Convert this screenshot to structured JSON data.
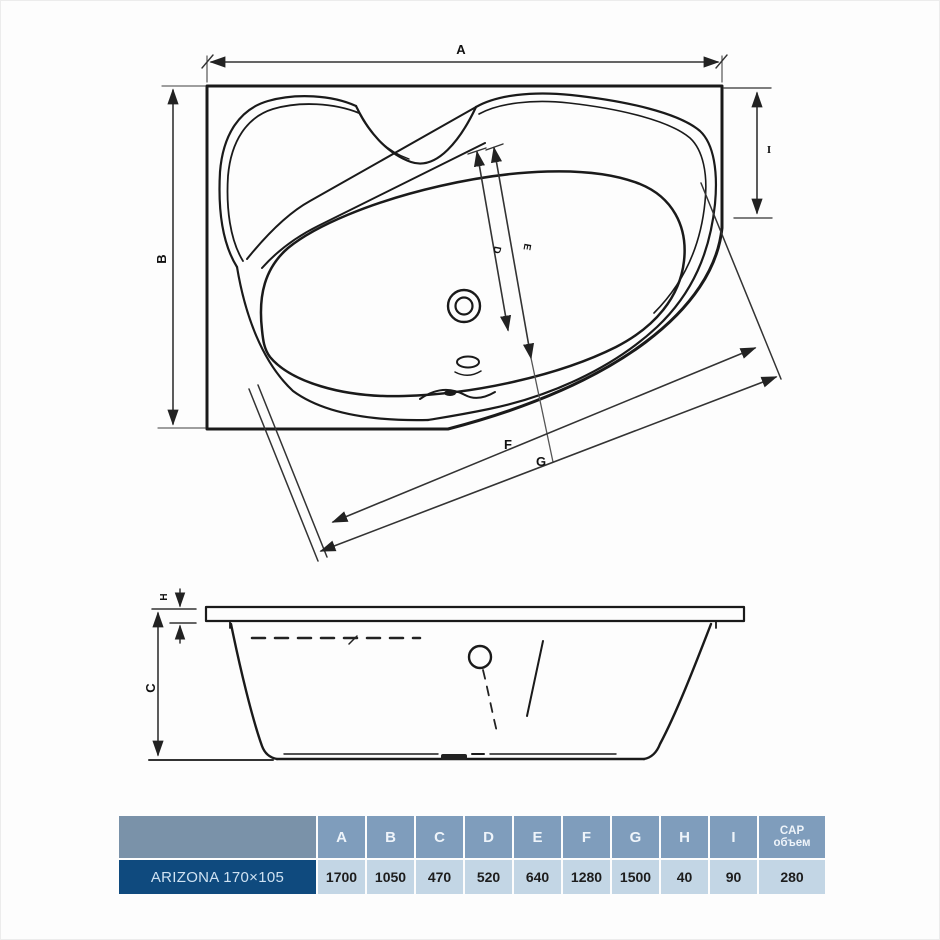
{
  "product": {
    "name": "ARIZONA 170×105"
  },
  "diagram": {
    "top_view_labels": {
      "a": "A",
      "b": "B",
      "i": "I",
      "d": "D",
      "e": "E",
      "f": "F",
      "g": "G"
    },
    "side_view_labels": {
      "h": "H",
      "c": "C"
    }
  },
  "table": {
    "columns": [
      "A",
      "B",
      "C",
      "D",
      "E",
      "F",
      "G",
      "H",
      "I"
    ],
    "cap_header": {
      "line1": "CAP",
      "line2": "объем"
    },
    "rows": [
      {
        "name": "ARIZONA 170×105",
        "values": [
          "1700",
          "1050",
          "470",
          "520",
          "640",
          "1280",
          "1500",
          "40",
          "90",
          "280"
        ]
      }
    ]
  },
  "colors": {
    "line": "#1a1a1a",
    "dimension_line": "#333333",
    "header_bg": "#7f9dbc",
    "header_name_bg": "#7a92a9",
    "row_name_bg": "#0f4a7e",
    "row_name_text": "#cfe2f2",
    "cell_bg": "#c3d6e5",
    "value_text": "#1d1d1d",
    "page_bg": "#fdfdfd"
  }
}
